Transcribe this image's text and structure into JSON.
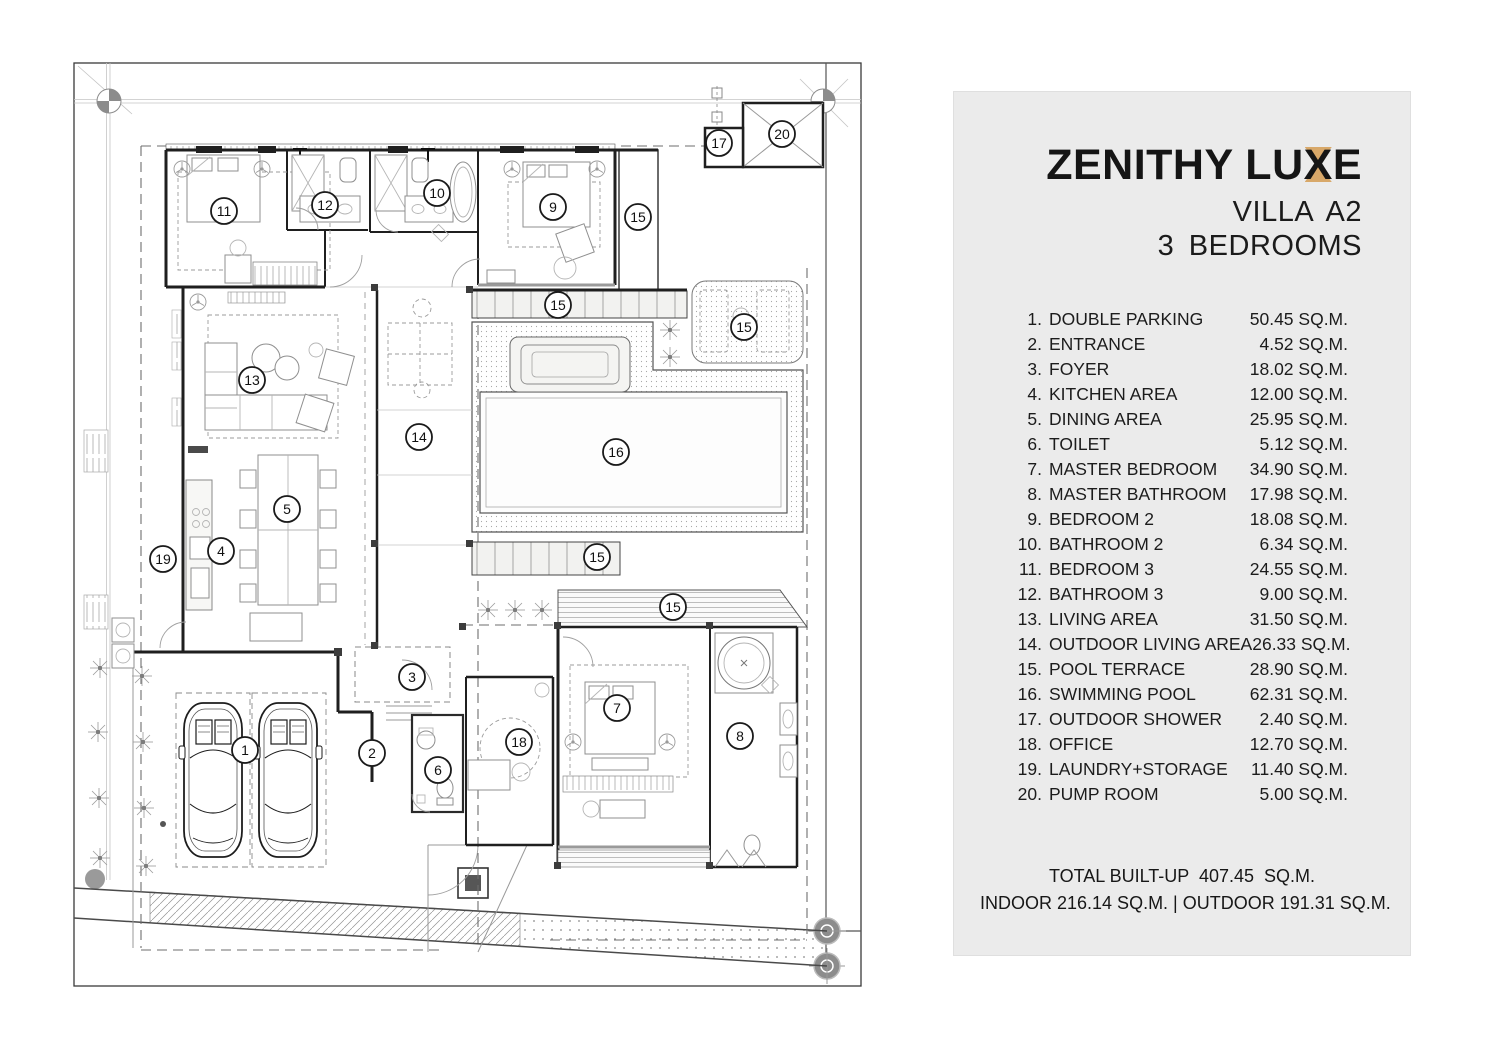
{
  "panel": {
    "brand": {
      "left": "ZENITHY LU",
      "accent_letter": "X",
      "right": "E",
      "accent_color": "#D8A869"
    },
    "villa": "VILLA A2",
    "bedrooms": "3 BEDROOMS",
    "rooms": [
      {
        "no": "1.",
        "name": "DOUBLE PARKING",
        "area": "50.45 SQ.M."
      },
      {
        "no": "2.",
        "name": "ENTRANCE",
        "area": "4.52 SQ.M."
      },
      {
        "no": "3.",
        "name": "FOYER",
        "area": "18.02 SQ.M."
      },
      {
        "no": "4.",
        "name": "KITCHEN AREA",
        "area": "12.00 SQ.M."
      },
      {
        "no": "5.",
        "name": "DINING AREA",
        "area": "25.95 SQ.M."
      },
      {
        "no": "6.",
        "name": "TOILET",
        "area": "5.12 SQ.M."
      },
      {
        "no": "7.",
        "name": "MASTER BEDROOM",
        "area": "34.90 SQ.M."
      },
      {
        "no": "8.",
        "name": "MASTER BATHROOM",
        "area": "17.98 SQ.M."
      },
      {
        "no": "9.",
        "name": "BEDROOM 2",
        "area": "18.08 SQ.M."
      },
      {
        "no": "10.",
        "name": "BATHROOM 2",
        "area": "6.34 SQ.M."
      },
      {
        "no": "11.",
        "name": "BEDROOM 3",
        "area": "24.55 SQ.M."
      },
      {
        "no": "12.",
        "name": "BATHROOM 3",
        "area": "9.00 SQ.M."
      },
      {
        "no": "13.",
        "name": "LIVING AREA",
        "area": "31.50 SQ.M."
      },
      {
        "no": "14.",
        "name": "OUTDOOR LIVING AREA",
        "area": "26.33 SQ.M."
      },
      {
        "no": "15.",
        "name": "POOL TERRACE",
        "area": "28.90 SQ.M."
      },
      {
        "no": "16.",
        "name": "SWIMMING POOL",
        "area": "62.31 SQ.M."
      },
      {
        "no": "17.",
        "name": "OUTDOOR SHOWER",
        "area": "2.40 SQ.M."
      },
      {
        "no": "18.",
        "name": "OFFICE",
        "area": "12.70 SQ.M."
      },
      {
        "no": "19.",
        "name": "LAUNDRY+STORAGE",
        "area": "11.40 SQ.M."
      },
      {
        "no": "20.",
        "name": "PUMP ROOM",
        "area": "5.00 SQ.M."
      }
    ],
    "total_line": "TOTAL BUILT-UP  407.45  SQ.M.",
    "indoor_outdoor_line": "INDOOR 216.14 SQ.M. | OUTDOOR 191.31 SQ.M."
  },
  "plan": {
    "balloons": [
      {
        "n": "11",
        "room": "BEDROOM 3",
        "x": 224,
        "y": 211
      },
      {
        "n": "12",
        "room": "BATHROOM 3",
        "x": 325,
        "y": 205
      },
      {
        "n": "10",
        "room": "BATHROOM 2",
        "x": 437,
        "y": 193
      },
      {
        "n": "9",
        "room": "BEDROOM 2",
        "x": 553,
        "y": 207
      },
      {
        "n": "15",
        "room": "POOL TERRACE",
        "x": 638,
        "y": 217
      },
      {
        "n": "17",
        "room": "OUTDOOR SHOWER",
        "x": 719,
        "y": 143
      },
      {
        "n": "20",
        "room": "PUMP ROOM",
        "x": 782,
        "y": 134
      },
      {
        "n": "15",
        "room": "POOL TERRACE",
        "x": 558,
        "y": 305
      },
      {
        "n": "15",
        "room": "POOL TERRACE",
        "x": 744,
        "y": 327
      },
      {
        "n": "13",
        "room": "LIVING AREA",
        "x": 252,
        "y": 380
      },
      {
        "n": "14",
        "room": "OUTDOOR LIVING AREA",
        "x": 419,
        "y": 437
      },
      {
        "n": "16",
        "room": "SWIMMING POOL",
        "x": 616,
        "y": 452
      },
      {
        "n": "5",
        "room": "DINING AREA",
        "x": 287,
        "y": 509
      },
      {
        "n": "4",
        "room": "KITCHEN AREA",
        "x": 221,
        "y": 551
      },
      {
        "n": "19",
        "room": "LAUNDRY+STORAGE",
        "x": 163,
        "y": 559
      },
      {
        "n": "15",
        "room": "POOL TERRACE",
        "x": 597,
        "y": 557
      },
      {
        "n": "15",
        "room": "POOL TERRACE",
        "x": 673,
        "y": 607
      },
      {
        "n": "3",
        "room": "FOYER",
        "x": 412,
        "y": 677
      },
      {
        "n": "7",
        "room": "MASTER BEDROOM",
        "x": 617,
        "y": 708
      },
      {
        "n": "1",
        "room": "DOUBLE PARKING",
        "x": 245,
        "y": 750
      },
      {
        "n": "2",
        "room": "ENTRANCE",
        "x": 372,
        "y": 753
      },
      {
        "n": "6",
        "room": "TOILET",
        "x": 438,
        "y": 770
      },
      {
        "n": "18",
        "room": "OFFICE",
        "x": 519,
        "y": 742
      },
      {
        "n": "8",
        "room": "MASTER BATHROOM",
        "x": 740,
        "y": 736
      }
    ]
  },
  "colors": {
    "panel_bg": "#EBEBEB",
    "accent": "#D8A869",
    "line": "#1F1F1F"
  }
}
